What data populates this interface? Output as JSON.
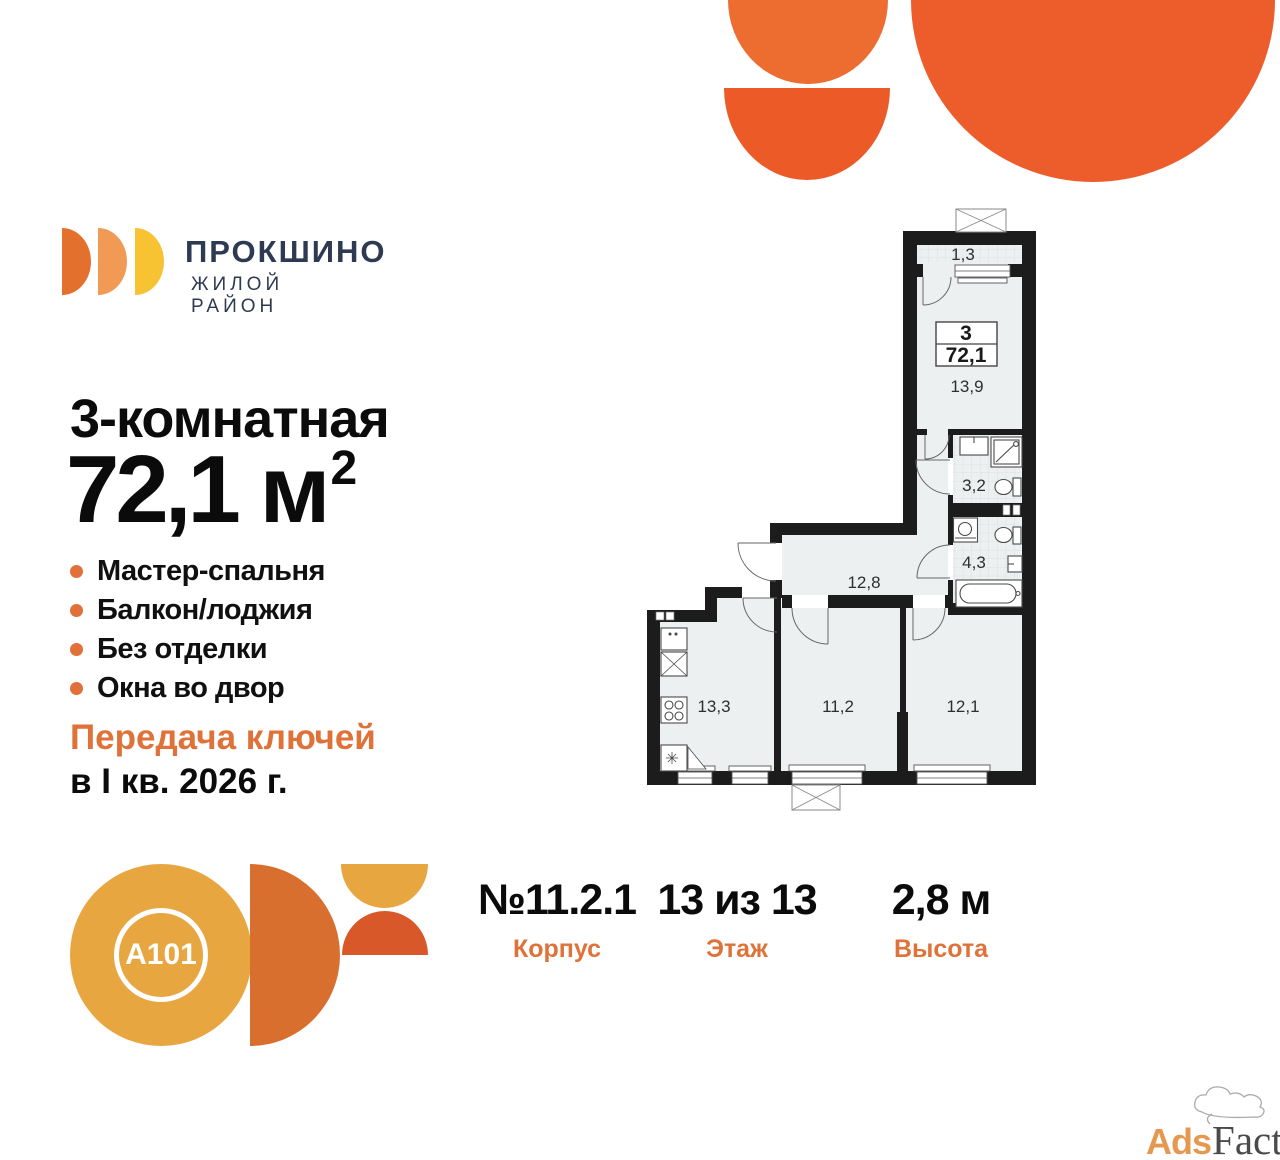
{
  "brand": {
    "name": "ПРОКШИНО",
    "tagline": "ЖИЛОЙ РАЙОН"
  },
  "listing": {
    "title": "3-комнатная",
    "area": {
      "value": "72,1",
      "unit": "м",
      "sup": "2"
    },
    "features": [
      "Мастер-спальня",
      "Балкон/лоджия",
      "Без отделки",
      "Окна во двор"
    ],
    "handover": {
      "line1": "Передача ключей",
      "line2": "в I кв. 2026 г."
    }
  },
  "floorplan": {
    "info_box": {
      "rooms": "3",
      "area": "72,1"
    },
    "labels": {
      "balcony": "1,3",
      "master_bedroom": "13,9",
      "bathroom_small": "3,2",
      "bathroom_big": "4,3",
      "hallway": "12,8",
      "kitchen": "13,3",
      "bedroom2": "11,2",
      "bedroom3": "12,1"
    }
  },
  "details": [
    {
      "value": "№11.2.1",
      "label": "Корпус"
    },
    {
      "value": "13 из 13",
      "label": "Этаж"
    },
    {
      "value": "2,8 м",
      "label": "Высота"
    }
  ],
  "developer": {
    "name": "A101"
  },
  "watermark": {
    "ads": "Ads",
    "factory": "Factory"
  },
  "colors": {
    "accent_orange": "#E2703A",
    "handover_orange": "#DF7238",
    "brand_navy": "#2E3A52",
    "decor_orange_big": "#ED5C2B",
    "decor_orange_small": "#ED6D31",
    "logo_d1": "#E4702D",
    "logo_d2": "#F09A55",
    "logo_d3": "#F7C333",
    "a101_gold": "#E8A640",
    "a101_orange": "#D96F2E",
    "a101_red_orange": "#D8582A",
    "plan_wall": "#1C1C1C",
    "plan_floor": "#EDF0F1"
  }
}
